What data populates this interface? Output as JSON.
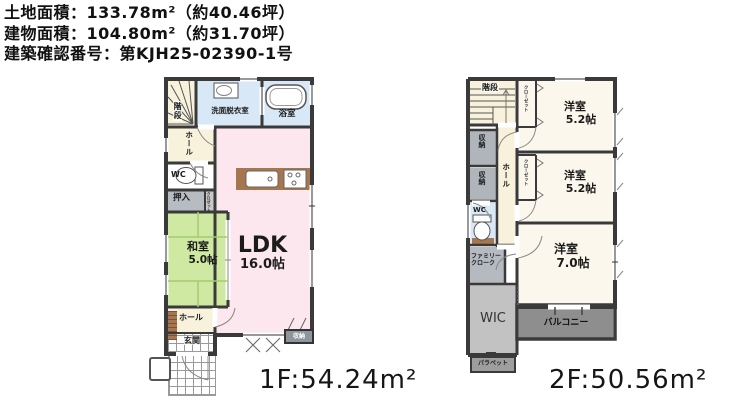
{
  "header": {
    "land_area": "土地面積：133.78m²（約40.46坪）",
    "building_area": "建物面積：104.80m²（約31.70坪）",
    "confirmation_number": "建築確認番号：第KJH25-02390-1号"
  },
  "floor1": {
    "area_label": "1F:54.24m²",
    "rooms": {
      "stairs": "階段",
      "washroom": "洗面脱衣室",
      "bathroom": "浴室",
      "hall_upper": "ホール",
      "wc": "WC",
      "oshiire": "押入",
      "closet_strip": "クロゼット",
      "washitsu_name": "和室",
      "washitsu_size": "5.0帖",
      "ldk_name": "LDK",
      "ldk_size": "16.0帖",
      "hall_lower": "ホール",
      "genkan": "玄関",
      "storage": "収納"
    }
  },
  "floor2": {
    "area_label": "2F:50.56m²",
    "rooms": {
      "stairs": "階段",
      "closet1": "クローゼット",
      "bedroom1_name": "洋室",
      "bedroom1_size": "5.2帖",
      "closet2": "クローゼット",
      "bedroom2_name": "洋室",
      "bedroom2_size": "5.2帖",
      "storage1": "収納",
      "storage2": "収納",
      "hall": "ホール",
      "wc": "WC",
      "family_cloak_line1": "ファミリー",
      "family_cloak_line2": "クローク",
      "wic": "WIC",
      "bedroom3_name": "洋室",
      "bedroom3_size": "7.0帖",
      "balcony": "バルコニー",
      "parapet": "パラペット"
    }
  },
  "colors": {
    "wall": "#3a3a3a",
    "ldk_pink": "#fbe7ed",
    "tatami_green": "#cfe9a2",
    "water_blue": "#d9e8f7",
    "cream": "#f8f1dc",
    "bedroom_cream": "#fbf7ec",
    "storage_gray": "#b7bcc2",
    "wic_gray": "#c2c2c2",
    "balcony_gray": "#8e8e8e",
    "counter_brown": "#a5764f"
  }
}
